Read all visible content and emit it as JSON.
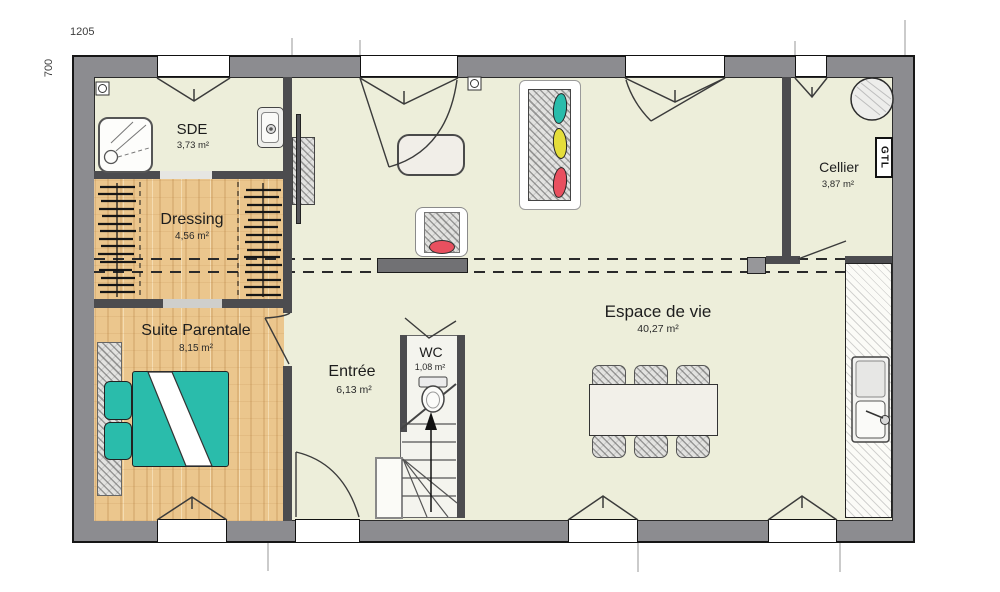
{
  "dimensions": {
    "width_label": "1205",
    "height_label": "700"
  },
  "rooms": {
    "sde": {
      "name": "SDE",
      "area": "3,73 m²"
    },
    "dressing": {
      "name": "Dressing",
      "area": "4,56 m²"
    },
    "suite": {
      "name": "Suite Parentale",
      "area": "8,15 m²"
    },
    "entree": {
      "name": "Entrée",
      "area": "6,13 m²"
    },
    "wc": {
      "name": "WC",
      "area": "1,08 m²"
    },
    "vie": {
      "name": "Espace de vie",
      "area": "40,27 m²"
    },
    "cellier": {
      "name": "Cellier",
      "area": "3,87 m²"
    }
  },
  "labels": {
    "gtl": "GTL"
  },
  "colors": {
    "outer_wall": "#8c8c90",
    "interior_wall": "#4c4c4f",
    "floor_cream": "#edeeda",
    "floor_wood": "#ebc68d",
    "bed_teal": "#2abcab",
    "pillow_yellow": "#e4dd3a",
    "pillow_red": "#e8505f"
  }
}
